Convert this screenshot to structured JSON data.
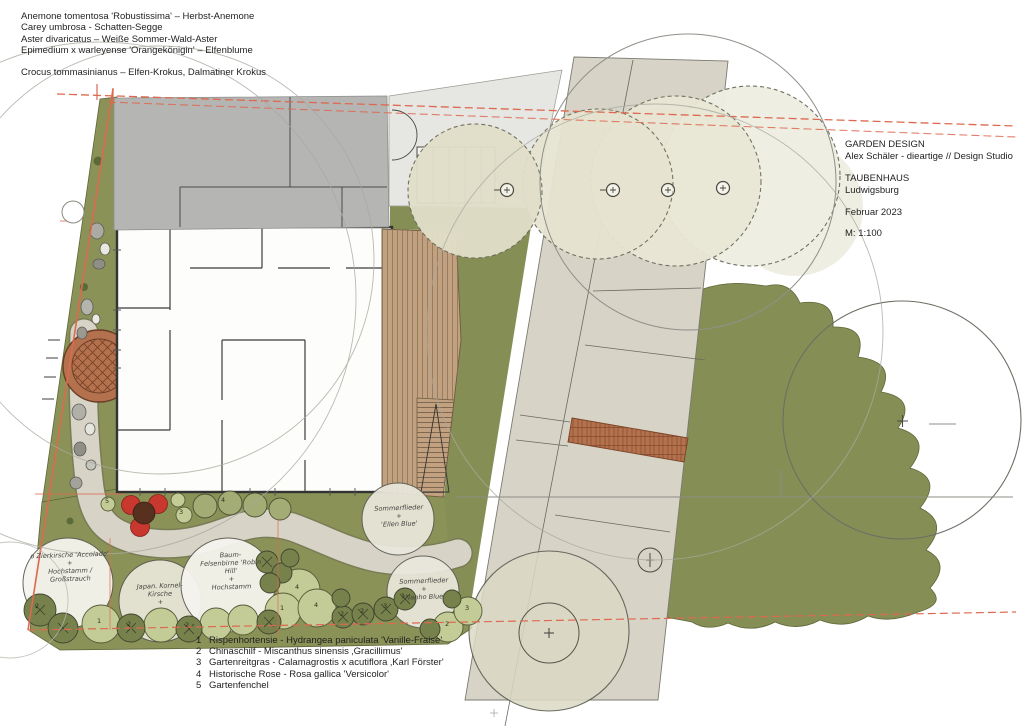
{
  "palette": {
    "olive": "#8a9257",
    "olive2": "#858f55",
    "olive-dark": "#76814c",
    "olive-mid": "#a4ac76",
    "olive-light": "#c3cb96",
    "cream1": "#e1dfc9",
    "cream2": "#e6e4d1",
    "cream3": "#e9e7d6",
    "cream4": "#efeee3",
    "white-tree": "#f5f4ee",
    "roof": "#b5b5b4",
    "entry": "#e6e6e2",
    "paving": "#d7d3c7",
    "deck": "#c2a180",
    "deck-line": "#8a7458",
    "brick": "#b4714e",
    "brick-line": "#7a4426",
    "boundary-red": "#dd6950",
    "rose-red": "#c8382f",
    "rose-brown": "#57301f",
    "ink": "#3c3c3c",
    "sketch": "#8e8e84",
    "hand": "#45453f"
  },
  "notes": {
    "lines": [
      "Anemone tomentosa 'Robustissima' – Herbst-Anemone",
      "Carey umbrosa - Schatten-Segge",
      "Aster divaricatus – Weiße Sommer-Wald-Aster",
      "Epimedium x warleyense 'Orangekönigin' – Elfenblume"
    ],
    "crocus_line": "Crocus tommasinianus – Elfen-Krokus, Dalmatiner Krokus"
  },
  "title_block": {
    "studio_line1": "GARDEN DESIGN",
    "studio_line2": "Alex Schäler - dieartige // Design Studio",
    "project": "TAUBENHAUS",
    "city": "Ludwigsburg",
    "date": "Februar 2023",
    "scale": "M: 1:100"
  },
  "legend": {
    "items": [
      {
        "num": "1",
        "text": "Rispenhortensie - Hydrangea paniculata 'Vanille-Fraise'"
      },
      {
        "num": "2",
        "text": "Chinaschilf - Miscanthus sinensis ‚Gracillimus'"
      },
      {
        "num": "3",
        "text": "Gartenreitgras - Calamagrostis x acutiflora ‚Karl Förster'"
      },
      {
        "num": "4",
        "text": "Historische Rose - Rosa gallica 'Versicolor'"
      },
      {
        "num": "5",
        "text": "Gartenfenchel"
      }
    ]
  },
  "plan": {
    "tree_labels": [
      {
        "lines": [
          "o Zierkirsche 'Accolade'",
          "+",
          "Hochstamm /",
          "Großstrauch"
        ]
      },
      {
        "lines": [
          "Japan. Kornel-",
          "Kirsche",
          "+"
        ]
      },
      {
        "lines": [
          "Baum-",
          "Felsenbirne 'Robin",
          "Hill'",
          "+",
          "Hochstamm"
        ]
      },
      {
        "lines": [
          "Sommerflieder",
          "+",
          "'Ellen Blue'"
        ]
      },
      {
        "lines": [
          "Sommerflieder",
          "+",
          "'Nanho Blue'"
        ]
      }
    ],
    "markers": [
      {
        "n": "2"
      },
      {
        "n": "1"
      },
      {
        "n": "2"
      },
      {
        "n": "2"
      },
      {
        "n": "5"
      },
      {
        "n": "3"
      },
      {
        "n": "4"
      },
      {
        "n": "4"
      },
      {
        "n": "1"
      },
      {
        "n": "4"
      },
      {
        "n": "2"
      },
      {
        "n": "2"
      },
      {
        "n": "3"
      },
      {
        "n": "1"
      },
      {
        "n": "2"
      },
      {
        "n": "3"
      }
    ]
  }
}
